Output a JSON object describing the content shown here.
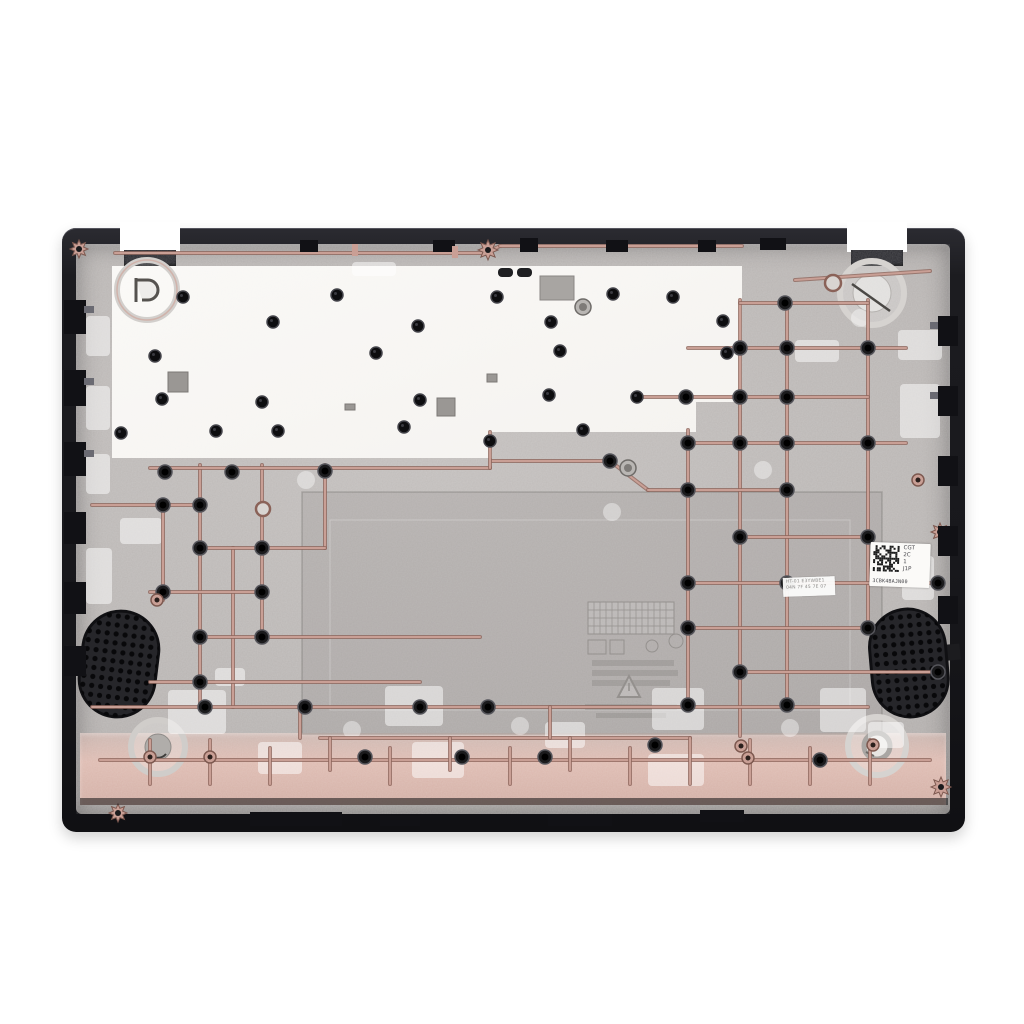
{
  "photo": {
    "subject": "laptop-bottom-case-interior",
    "colors": {
      "background": "#ffffff",
      "rim_black": "#1c1c20",
      "rim_highlight": "#4a4a52",
      "interior_silver": "#b8b4b2",
      "plate_white": "#f5f3f0",
      "copper": "#c99f95",
      "copper_dark": "#8f675d",
      "pink_band": "#debbb1",
      "boss_black": "#141416",
      "grille_black": "#26262a"
    }
  },
  "qr_sticker": {
    "lines": [
      "CGT",
      "2C",
      "1",
      "J1P"
    ],
    "code": "3CBK4BAJN00"
  },
  "service_label": {
    "line1": "HT-01 E3YWBE1",
    "line2": "04N 7F 45 7E 07"
  }
}
